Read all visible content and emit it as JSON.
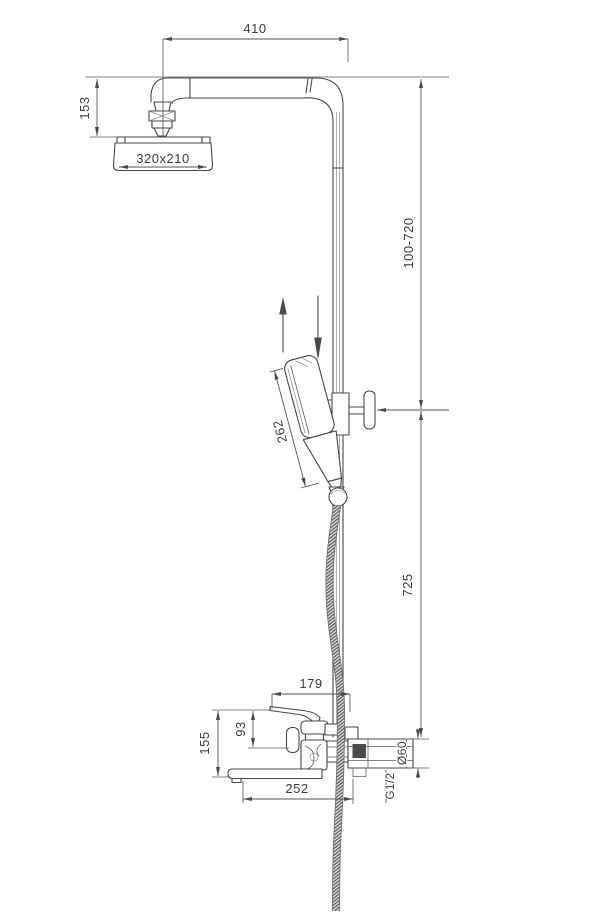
{
  "drawing": {
    "dimensions": {
      "top_arm_width": "410",
      "head_drop": "153",
      "head_size": "320x210",
      "riser_adjust_range": "100-720",
      "hand_shower_length": "262",
      "riser_lower_height": "725",
      "mixer_width": "179",
      "lever_to_body": "93",
      "lever_to_spout": "155",
      "spout_length": "252",
      "wall_flange_diameter": "Ø60",
      "thread_size": "G1/2"
    },
    "colors": {
      "line": "#474747",
      "dimension": "#555555",
      "text": "#3c3c3c",
      "background": "#ffffff"
    }
  }
}
